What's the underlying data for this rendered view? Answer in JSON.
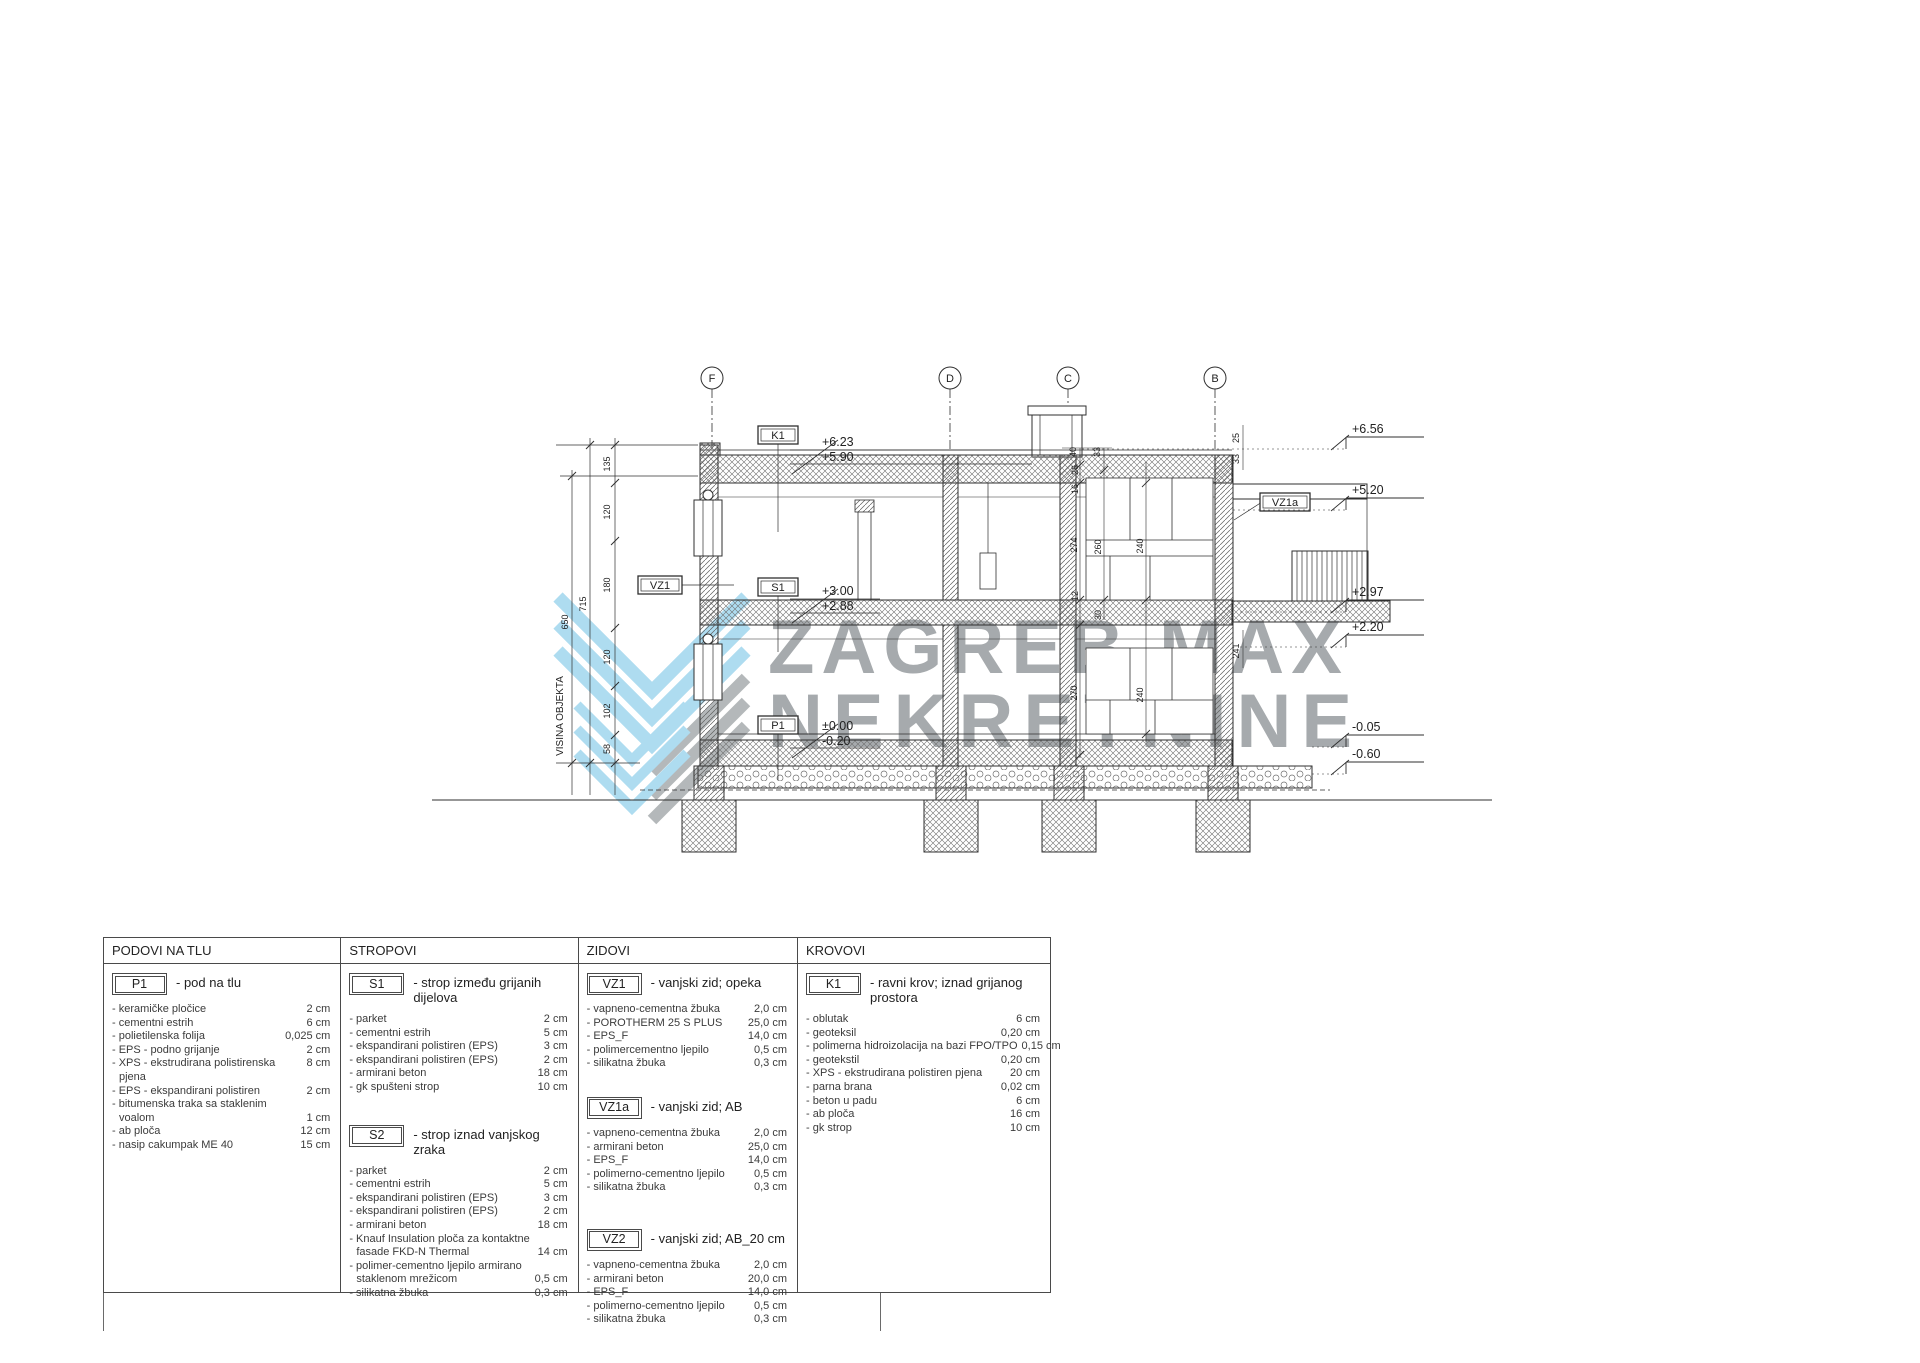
{
  "watermark": {
    "line1": "ZAGREB MAX",
    "line2": "NEKRETNINE",
    "logo_blue": "#aedcf0",
    "logo_gray": "#b4b8ba",
    "text_gray": "#a6aaad"
  },
  "dw": {
    "grid": {
      "g0": "F",
      "g1": "D",
      "g2": "C",
      "g3": "B"
    },
    "lv": {
      "l0": "+6.56",
      "l1": "+5.20",
      "l2": "+2.97",
      "l3": "+2.20",
      "l4": "-0.05",
      "l5": "-0.60"
    },
    "mk": {
      "k1": "K1",
      "k1a": "+6.23",
      "k1b": "+5.90",
      "s1": "S1",
      "s1a": "+3.00",
      "s1b": "+2.88",
      "p1": "P1",
      "p1a": "±0.00",
      "p1b": "-0.20",
      "vz1": "VZ1",
      "vz1a": "VZ1a"
    },
    "hl": "VISINA OBJEKTA",
    "dim": {
      "d0": "135",
      "d1": "120",
      "d2": "180",
      "d3": "120",
      "d4": "102",
      "d5": "58",
      "d6": "715",
      "d7": "650",
      "d9": "40",
      "d10": "33",
      "d11": "26",
      "d12": "16",
      "d13": "274",
      "d14": "260",
      "d15": "240",
      "d16": "12",
      "d17": "30",
      "d18": "270",
      "d19": "240",
      "d20": "25",
      "d21": "33",
      "d22": "241"
    }
  },
  "lg": {
    "c0": {
      "h": "PODOVI NA TLU",
      "s0": {
        "code": "P1",
        "title": "- pod na tlu",
        "i0": {
          "n": "- keramičke pločice",
          "v": "2 cm"
        },
        "i1": {
          "n": "- cementni estrih",
          "v": "6 cm"
        },
        "i2": {
          "n": "- polietilenska folija",
          "v": "0,025 cm"
        },
        "i3": {
          "n": "- EPS - podno grijanje",
          "v": "2 cm"
        },
        "i4": {
          "n": "- XPS - ekstrudirana polistirenska",
          "v": "8 cm"
        },
        "i5": {
          "n": "pjena",
          "v": ""
        },
        "i6": {
          "n": "- EPS - ekspandirani polistiren",
          "v": "2 cm"
        },
        "i7": {
          "n": "- bitumenska traka sa staklenim",
          "v": ""
        },
        "i8": {
          "n": "voalom",
          "v": "1 cm"
        },
        "i9": {
          "n": "- ab ploča",
          "v": "12 cm"
        },
        "i10": {
          "n": "- nasip cakumpak ME 40",
          "v": "15 cm"
        }
      }
    },
    "c1": {
      "h": "STROPOVI",
      "s0": {
        "code": "S1",
        "title": "- strop između grijanih dijelova",
        "i0": {
          "n": "- parket",
          "v": "2 cm"
        },
        "i1": {
          "n": "- cementni estrih",
          "v": "5 cm"
        },
        "i2": {
          "n": "- ekspandirani polistiren (EPS)",
          "v": "3 cm"
        },
        "i3": {
          "n": "- ekspandirani polistiren (EPS)",
          "v": "2 cm"
        },
        "i4": {
          "n": "- armirani beton",
          "v": "18 cm"
        },
        "i5": {
          "n": "- gk spušteni strop",
          "v": "10 cm"
        }
      },
      "s1": {
        "code": "S2",
        "title": "- strop iznad vanjskog zraka",
        "i0": {
          "n": "- parket",
          "v": "2 cm"
        },
        "i1": {
          "n": "- cementni estrih",
          "v": "5 cm"
        },
        "i2": {
          "n": "- ekspandirani polistiren (EPS)",
          "v": "3 cm"
        },
        "i3": {
          "n": "- ekspandirani polistiren (EPS)",
          "v": "2 cm"
        },
        "i4": {
          "n": "- armirani beton",
          "v": "18 cm"
        },
        "i5": {
          "n": "- Knauf Insulation ploča za kontaktne",
          "v": ""
        },
        "i6": {
          "n": "fasade FKD-N Thermal",
          "v": "14 cm"
        },
        "i7": {
          "n": "- polimer-cementno ljepilo armirano",
          "v": ""
        },
        "i8": {
          "n": "staklenom mrežicom",
          "v": "0,5 cm"
        },
        "i9": {
          "n": "- silikatna žbuka",
          "v": "0,3 cm"
        }
      }
    },
    "c2": {
      "h": "ZIDOVI",
      "s0": {
        "code": "VZ1",
        "title": "- vanjski zid; opeka",
        "i0": {
          "n": "- vapneno-cementna žbuka",
          "v": "2,0 cm"
        },
        "i1": {
          "n": "- POROTHERM 25 S PLUS",
          "v": "25,0 cm"
        },
        "i2": {
          "n": "- EPS_F",
          "v": "14,0 cm"
        },
        "i3": {
          "n": "- polimercementno ljepilo",
          "v": "0,5 cm"
        },
        "i4": {
          "n": "- silikatna žbuka",
          "v": "0,3 cm"
        }
      },
      "s1": {
        "code": "VZ1a",
        "title": "- vanjski zid; AB",
        "i0": {
          "n": "- vapneno-cementna žbuka",
          "v": "2,0 cm"
        },
        "i1": {
          "n": "- armirani beton",
          "v": "25,0 cm"
        },
        "i2": {
          "n": "- EPS_F",
          "v": "14,0 cm"
        },
        "i3": {
          "n": "- polimerno-cementno ljepilo",
          "v": "0,5 cm"
        },
        "i4": {
          "n": "- silikatna žbuka",
          "v": "0,3 cm"
        }
      },
      "s2": {
        "code": "VZ2",
        "title": "- vanjski zid; AB_20 cm",
        "i0": {
          "n": "- vapneno-cementna žbuka",
          "v": "2,0 cm"
        },
        "i1": {
          "n": "- armirani beton",
          "v": "20,0 cm"
        },
        "i2": {
          "n": "- EPS_F",
          "v": "14,0 cm"
        },
        "i3": {
          "n": "- polimerno-cementno ljepilo",
          "v": "0,5 cm"
        },
        "i4": {
          "n": "- silikatna žbuka",
          "v": "0,3 cm"
        }
      }
    },
    "c3": {
      "h": "KROVOVI",
      "s0": {
        "code": "K1",
        "title": "- ravni krov; iznad grijanog prostora",
        "i0": {
          "n": "- oblutak",
          "v": "6 cm"
        },
        "i1": {
          "n": "- geoteksil",
          "v": "0,20 cm"
        },
        "i2": {
          "n": "- polimerna hidroizolacija na bazi FPO/TPO",
          "v": "0,15 cm"
        },
        "i3": {
          "n": "- geotekstil",
          "v": "0,20 cm"
        },
        "i4": {
          "n": "- XPS - ekstrudirana polistiren pjena",
          "v": "20 cm"
        },
        "i5": {
          "n": "- parna brana",
          "v": "0,02 cm"
        },
        "i6": {
          "n": "- beton u padu",
          "v": "6 cm"
        },
        "i7": {
          "n": "- ab ploča",
          "v": "16 cm"
        },
        "i8": {
          "n": "- gk strop",
          "v": "10 cm"
        }
      }
    }
  }
}
